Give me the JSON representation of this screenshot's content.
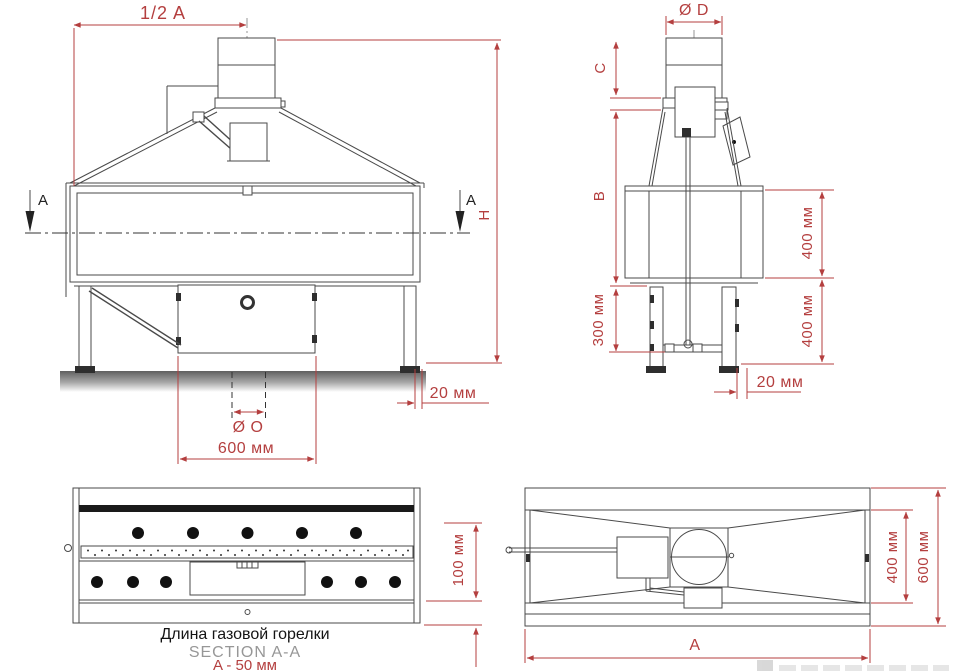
{
  "drawing": {
    "type": "technical-drawing",
    "colors": {
      "dimension_red": "#b43f3f",
      "line_gray": "#4a4a4a",
      "section_text_gray": "#979797",
      "caption_black": "#141414"
    },
    "front": {
      "half_a": "1/2 A",
      "h": "H",
      "offset20": "20 мм",
      "dia_o": "Ø O",
      "w600": "600 мм",
      "section_left": "A",
      "section_right": "A"
    },
    "side": {
      "dia_d": "Ø D",
      "c": "C",
      "b": "B",
      "h300": "300 мм",
      "v400_top": "400 мм",
      "v400_bottom": "400 мм",
      "offset20": "20 мм"
    },
    "section": {
      "h100": "100 мм",
      "caption_ru": "Длина газовой горелки",
      "caption_en": "SECTION A-A",
      "caption_dim": "A - 50 мм"
    },
    "top": {
      "a": "A",
      "w400": "400 мм",
      "w600": "600 мм"
    }
  }
}
